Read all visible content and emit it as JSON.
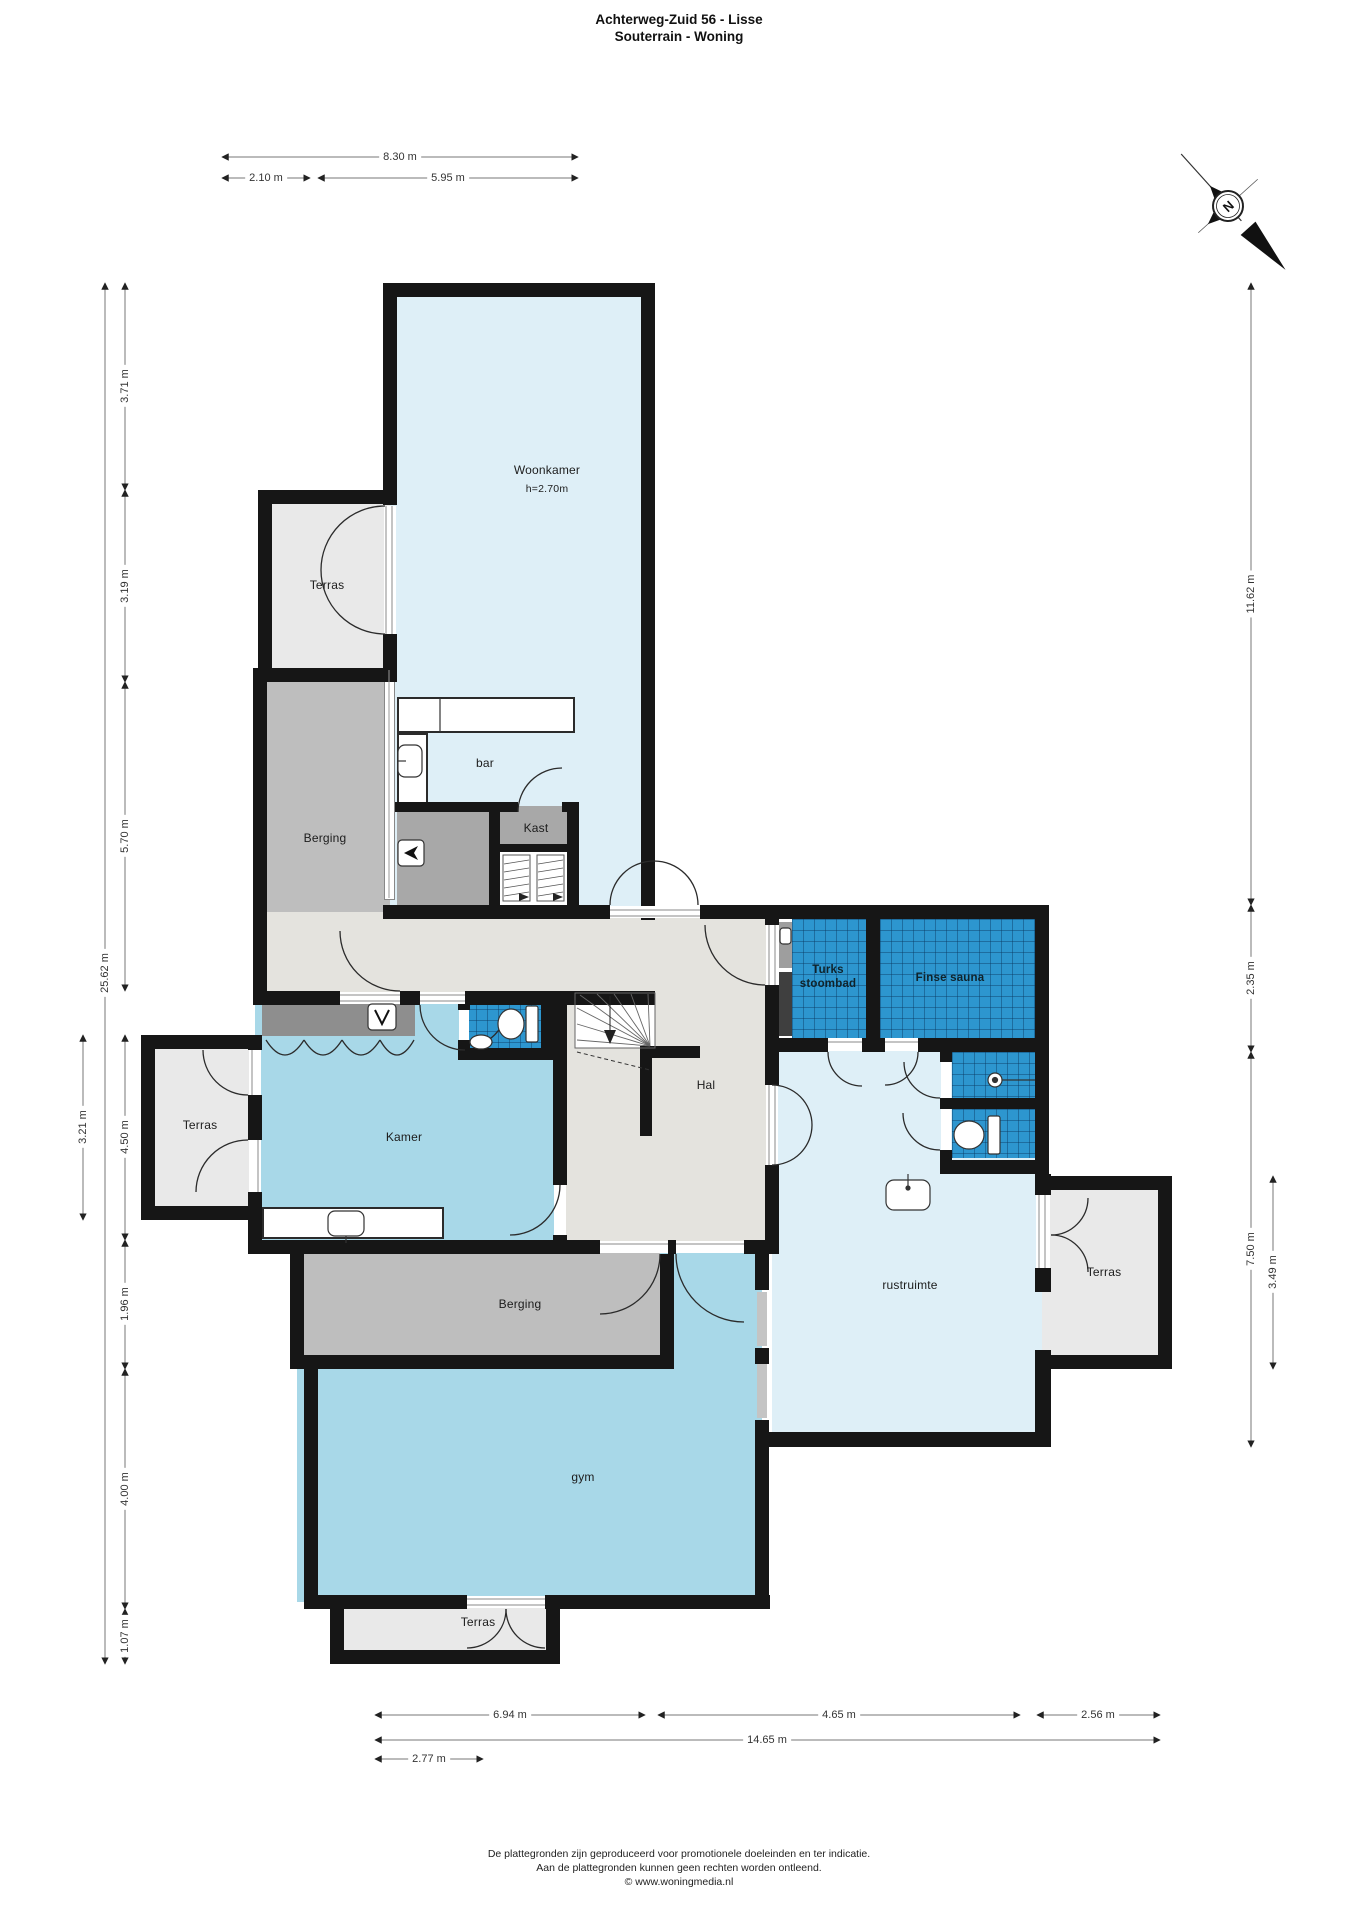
{
  "title": {
    "line1": "Achterweg-Zuid 56 - Lisse",
    "line2": "Souterrain - Woning"
  },
  "compass": {
    "north_label": "N"
  },
  "rooms": {
    "woonkamer": {
      "label": "Woonkamer",
      "ceiling_height": "h=2.70m"
    },
    "terras_top_left": {
      "label": "Terras"
    },
    "berging_top": {
      "label": "Berging"
    },
    "bar": {
      "label": "bar"
    },
    "kast": {
      "label": "Kast"
    },
    "hal": {
      "label": "Hal"
    },
    "kamer": {
      "label": "Kamer"
    },
    "terras_left": {
      "label": "Terras"
    },
    "turks_stoombad": {
      "line1": "Turks",
      "line2": "stoombad"
    },
    "finse_sauna": {
      "label": "Finse sauna"
    },
    "rustruimte": {
      "label": "rustruimte"
    },
    "terras_right": {
      "label": "Terras"
    },
    "berging_mid": {
      "label": "Berging"
    },
    "gym": {
      "label": "gym"
    },
    "terras_bottom": {
      "label": "Terras"
    }
  },
  "dimensions": {
    "top": [
      {
        "label": "8.30 m"
      },
      {
        "label": "2.10 m"
      },
      {
        "label": "5.95 m"
      }
    ],
    "left": [
      {
        "label": "25.62 m"
      },
      {
        "label": "3.71 m"
      },
      {
        "label": "3.19 m"
      },
      {
        "label": "5.70 m"
      },
      {
        "label": "4.50 m"
      },
      {
        "label": "1.96 m"
      },
      {
        "label": "4.00 m"
      },
      {
        "label": "1.07 m"
      },
      {
        "label": "3.21 m"
      }
    ],
    "right": [
      {
        "label": "11.62 m"
      },
      {
        "label": "2.35 m"
      },
      {
        "label": "7.50 m"
      },
      {
        "label": "3.49 m"
      }
    ],
    "bottom": [
      {
        "label": "6.94 m"
      },
      {
        "label": "4.65 m"
      },
      {
        "label": "2.56 m"
      },
      {
        "label": "14.65 m"
      },
      {
        "label": "2.77 m"
      }
    ]
  },
  "footer": {
    "line1": "De plattegronden zijn geproduceerd voor promotionele doeleinden en ter indicatie.",
    "line2": "Aan de plattegronden kunnen geen rechten worden ontleend.",
    "line3": "© www.woningmedia.nl"
  },
  "colors": {
    "wall": "#161616",
    "pale": "#DEEFF7",
    "bright": "#A8D8E8",
    "tile": "#2D96CF",
    "greige": "#E4E3DE",
    "terras": "#E9E9E9",
    "berging": "#BEBEBE",
    "tech": "#A8A8A8",
    "closet": "#8E8E8E",
    "cdark": "#3F3F3F",
    "cgray": "#9E9E9E",
    "slot": "#C4C4C4"
  }
}
